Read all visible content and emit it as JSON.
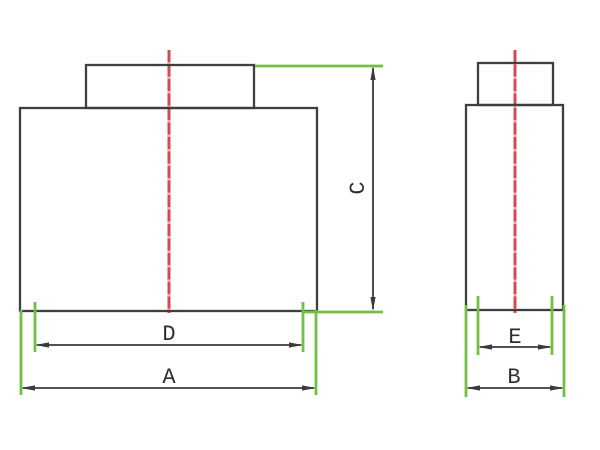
{
  "drawing": {
    "dimension_labels": {
      "A": "A",
      "B": "B",
      "C": "C",
      "D": "D",
      "E": "E"
    },
    "colors": {
      "outline": "#3f3f3f",
      "dimension": "#3a3a3a",
      "extension_green": "#72bf44",
      "centerline_red": "#d94850",
      "centerline_red_light": "#eda9ad",
      "label": "#2e2e2e",
      "background": "#ffffff"
    }
  }
}
